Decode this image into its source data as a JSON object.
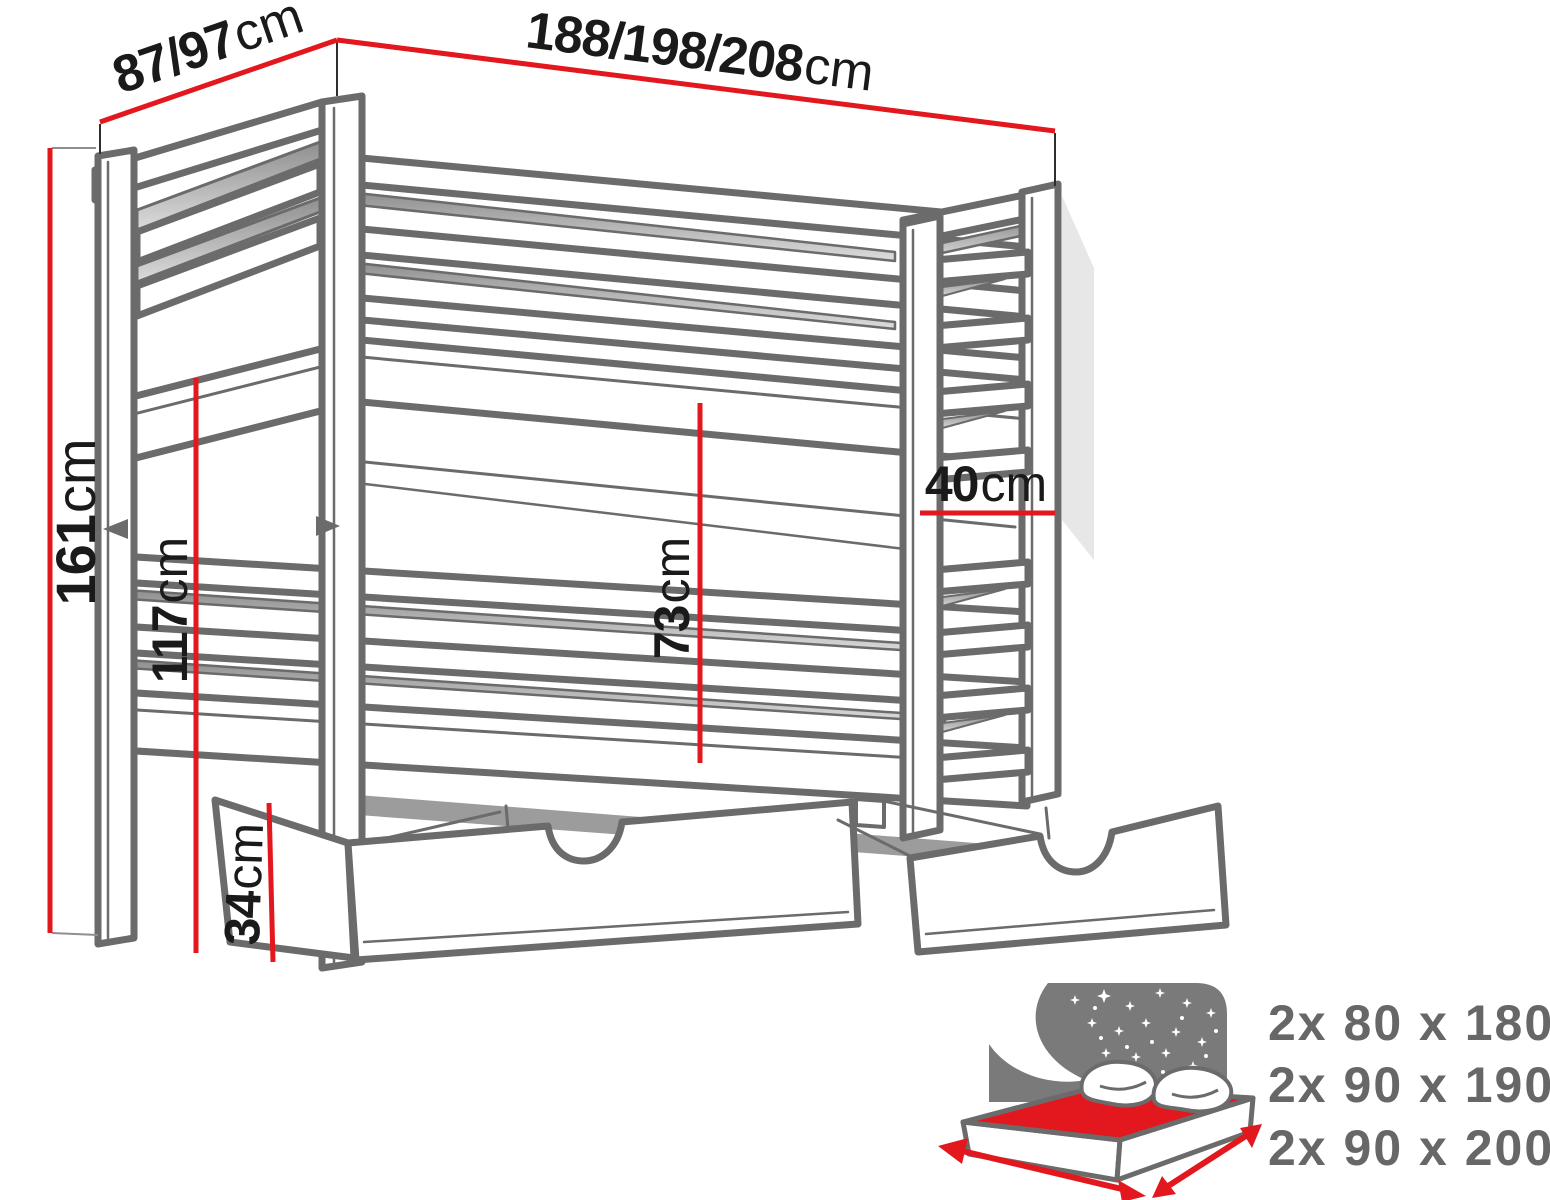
{
  "diagram_title": "bunk-bed-dimension-diagram",
  "dimensions": {
    "head_width": {
      "value": "87/97",
      "unit": "cm"
    },
    "length": {
      "value": "188/198/208",
      "unit": "cm"
    },
    "total_height": {
      "value": "161",
      "unit": "cm"
    },
    "upper_bunk_height": {
      "value": "117",
      "unit": "cm"
    },
    "lower_clearance": {
      "value": "73",
      "unit": "cm"
    },
    "ladder_width": {
      "value": "40",
      "unit": "cm"
    },
    "drawer_height": {
      "value": "34",
      "unit": "cm"
    }
  },
  "mattress_sizes": {
    "items": [
      "2x 80 x 180",
      "2x 90 x 190",
      "2x 90 x 200"
    ]
  },
  "colors": {
    "dimension_red": "#e2181e",
    "outline_gray": "#6b6b6b",
    "panel_gray": "#7a7a7a",
    "text_dark": "#1a1a1a",
    "text_gray": "#676767"
  }
}
